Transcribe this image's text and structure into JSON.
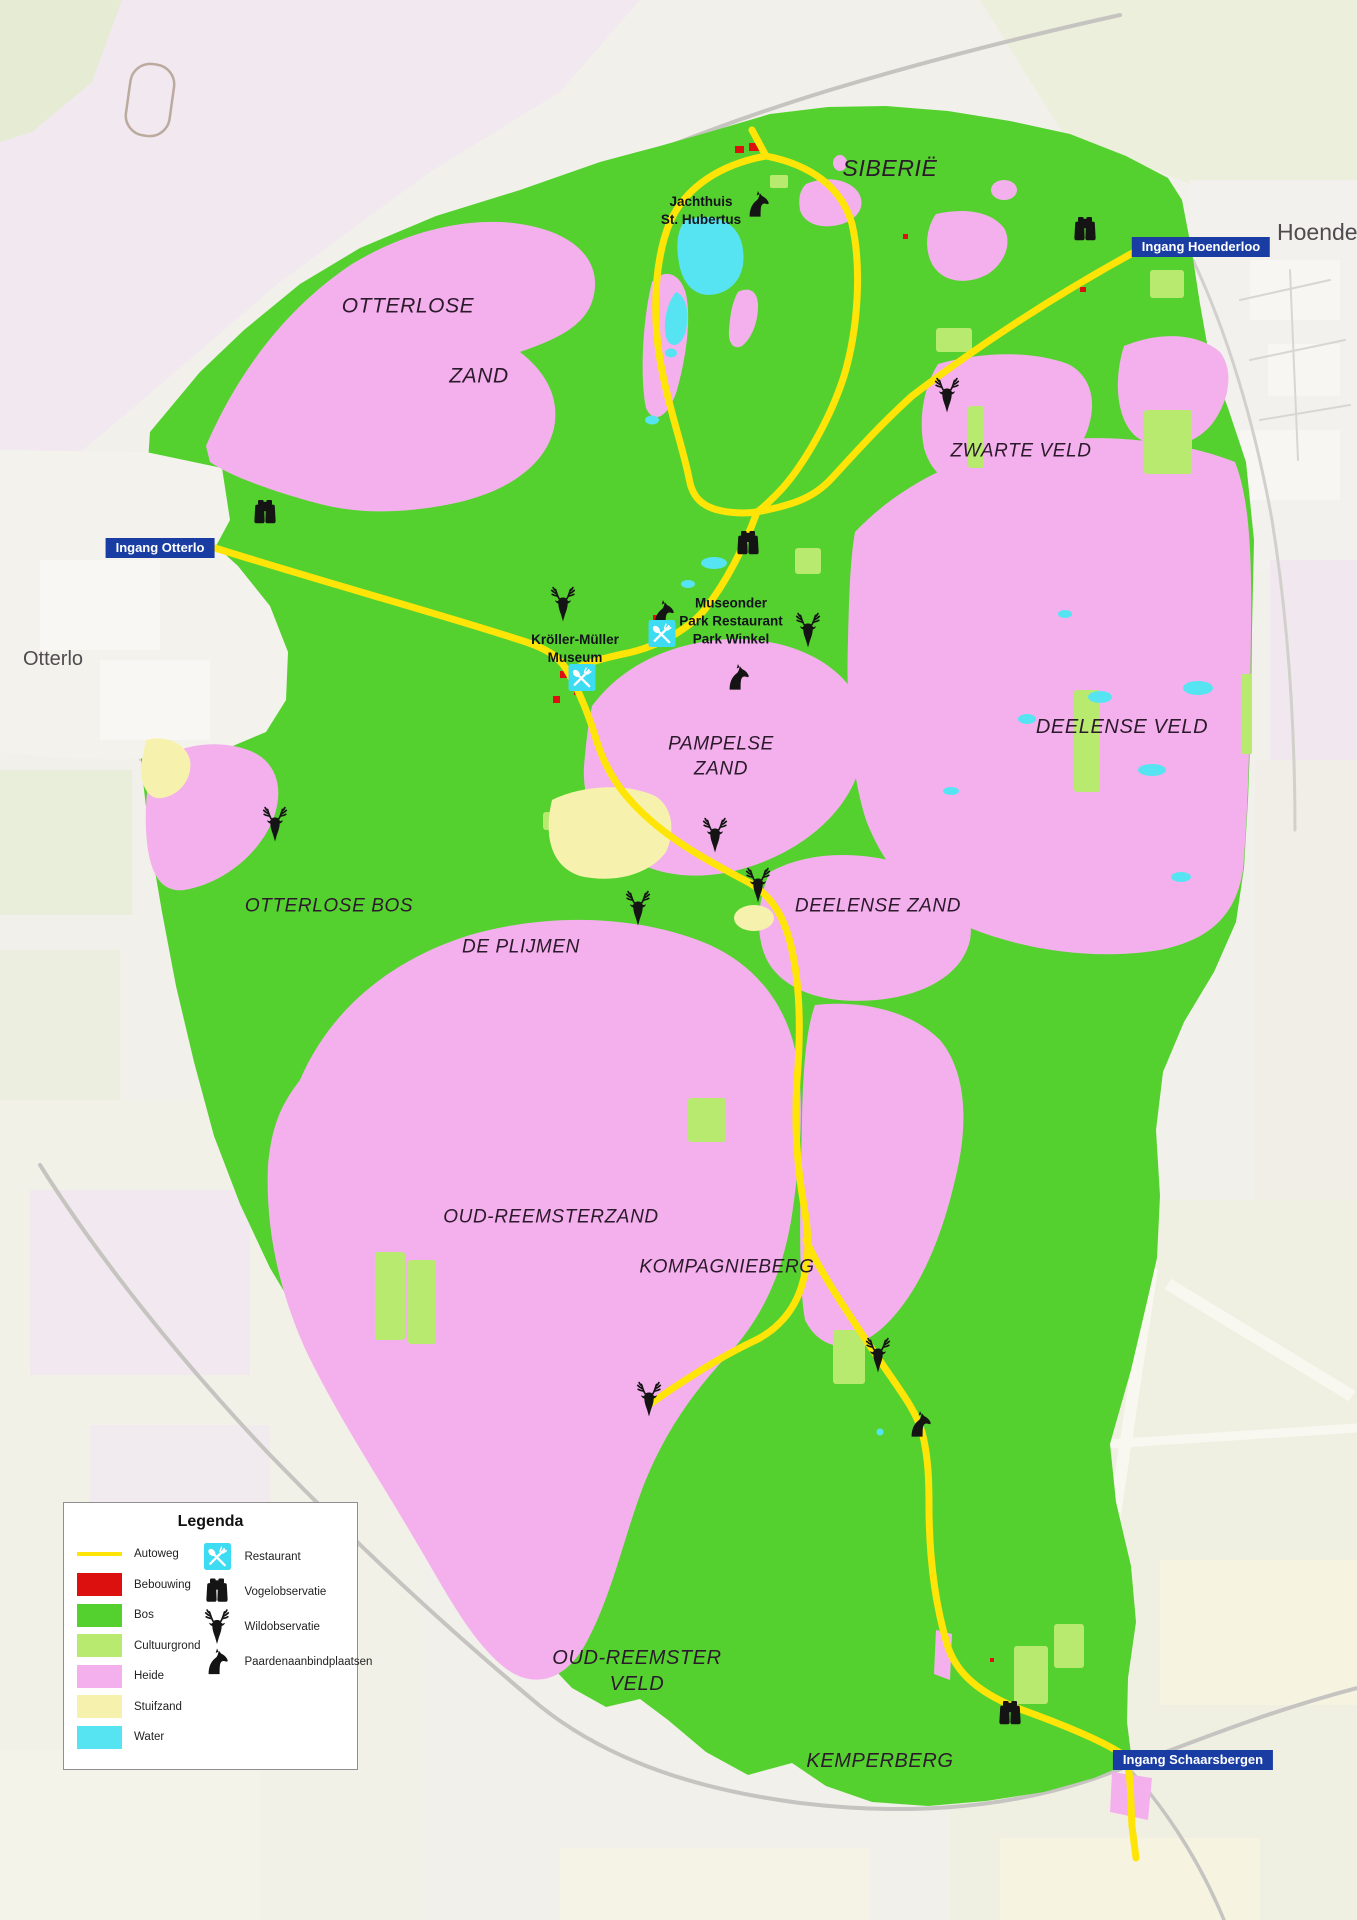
{
  "colors": {
    "bos": "#55d12f",
    "cultuurgrond": "#b7ea6e",
    "heide": "#f4b0ec",
    "stuifzand": "#f6f2ae",
    "water": "#57e4f2",
    "bebouwing": "#dd1010",
    "autoweg": "#ffe408",
    "badge_blue": "#1a3da4",
    "label_dark": "#2b1a2b",
    "town_gray": "#4f4b4f"
  },
  "legend": {
    "title": "Legenda",
    "areas": [
      {
        "label": "Autoweg",
        "swatch": "autoweg",
        "style": "line"
      },
      {
        "label": "Bebouwing",
        "swatch": "bebouwing",
        "style": "fill"
      },
      {
        "label": "Bos",
        "swatch": "bos",
        "style": "fill"
      },
      {
        "label": "Cultuurgrond",
        "swatch": "cultuurgrond",
        "style": "fill"
      },
      {
        "label": "Heide",
        "swatch": "heide",
        "style": "fill"
      },
      {
        "label": "Stuifzand",
        "swatch": "stuifzand",
        "style": "fill"
      },
      {
        "label": "Water",
        "swatch": "water",
        "style": "fill"
      }
    ],
    "symbols": [
      {
        "label": "Restaurant",
        "icon": "restaurant"
      },
      {
        "label": "Vogelobservatie",
        "icon": "binoculars"
      },
      {
        "label": "Wildobservatie",
        "icon": "deer"
      },
      {
        "label": "Paardenaanbindplaatsen",
        "icon": "horse"
      }
    ]
  },
  "regions": [
    {
      "text": "SIBERIË",
      "x": 890,
      "y": 169,
      "fs": 23
    },
    {
      "text": "OTTERLOSE",
      "x": 408,
      "y": 306,
      "fs": 21
    },
    {
      "text": "ZAND",
      "x": 479,
      "y": 376,
      "fs": 21
    },
    {
      "text": "ZWARTE VELD",
      "x": 1021,
      "y": 452,
      "fs": 19
    },
    {
      "text": "DEELENSE VELD",
      "x": 1122,
      "y": 727,
      "fs": 20
    },
    {
      "text": "PAMPELSE\nZAND",
      "x": 721,
      "y": 757,
      "fs": 19
    },
    {
      "text": "OTTERLOSE BOS",
      "x": 329,
      "y": 907,
      "fs": 19
    },
    {
      "text": "DE PLIJMEN",
      "x": 521,
      "y": 948,
      "fs": 19
    },
    {
      "text": "DEELENSE ZAND",
      "x": 878,
      "y": 907,
      "fs": 19
    },
    {
      "text": "OUD-REEMSTERZAND",
      "x": 551,
      "y": 1218,
      "fs": 19
    },
    {
      "text": "KOMPAGNIEBERG",
      "x": 727,
      "y": 1268,
      "fs": 19
    },
    {
      "text": "OUD-REEMSTER\nVELD",
      "x": 637,
      "y": 1671,
      "fs": 20
    },
    {
      "text": "KEMPERBERG",
      "x": 880,
      "y": 1761,
      "fs": 20
    }
  ],
  "pois": [
    {
      "text": "Jachthuis\nSt. Hubertus",
      "x": 701,
      "y": 211,
      "fs": 13.5
    },
    {
      "text": "Museonder\nPark Restaurant\nPark Winkel",
      "x": 731,
      "y": 621,
      "fs": 13.5
    },
    {
      "text": "Kröller-Müller\nMuseum",
      "x": 575,
      "y": 649,
      "fs": 13.5
    }
  ],
  "towns": [
    {
      "text": "Otterlo",
      "x": 53,
      "y": 659,
      "fs": 20,
      "anchor": "center"
    },
    {
      "text": "Hoenderloo",
      "x": 1277,
      "y": 233,
      "fs": 23,
      "anchor": "left"
    }
  ],
  "entrances": [
    {
      "label": "Ingang Hoenderloo",
      "x": 1201,
      "y": 247
    },
    {
      "label": "Ingang Otterlo",
      "x": 160,
      "y": 548
    },
    {
      "label": "Ingang Schaarsbergen",
      "x": 1193,
      "y": 1760
    }
  ],
  "observation_icons": [
    {
      "type": "binoculars",
      "x": 1085,
      "y": 233
    },
    {
      "type": "binoculars",
      "x": 265,
      "y": 516
    },
    {
      "type": "binoculars",
      "x": 748,
      "y": 547
    },
    {
      "type": "binoculars",
      "x": 1010,
      "y": 1717
    },
    {
      "type": "deer",
      "x": 947,
      "y": 398
    },
    {
      "type": "deer",
      "x": 563,
      "y": 607
    },
    {
      "type": "deer",
      "x": 808,
      "y": 633
    },
    {
      "type": "deer",
      "x": 275,
      "y": 827
    },
    {
      "type": "deer",
      "x": 715,
      "y": 838
    },
    {
      "type": "deer",
      "x": 758,
      "y": 888
    },
    {
      "type": "deer",
      "x": 638,
      "y": 911
    },
    {
      "type": "deer",
      "x": 878,
      "y": 1358
    },
    {
      "type": "deer",
      "x": 649,
      "y": 1402
    },
    {
      "type": "horse",
      "x": 758,
      "y": 207
    },
    {
      "type": "horse",
      "x": 663,
      "y": 616
    },
    {
      "type": "horse",
      "x": 738,
      "y": 680
    },
    {
      "type": "horse",
      "x": 920,
      "y": 1427
    },
    {
      "type": "restaurant",
      "x": 662,
      "y": 636
    },
    {
      "type": "restaurant",
      "x": 582,
      "y": 680
    }
  ]
}
